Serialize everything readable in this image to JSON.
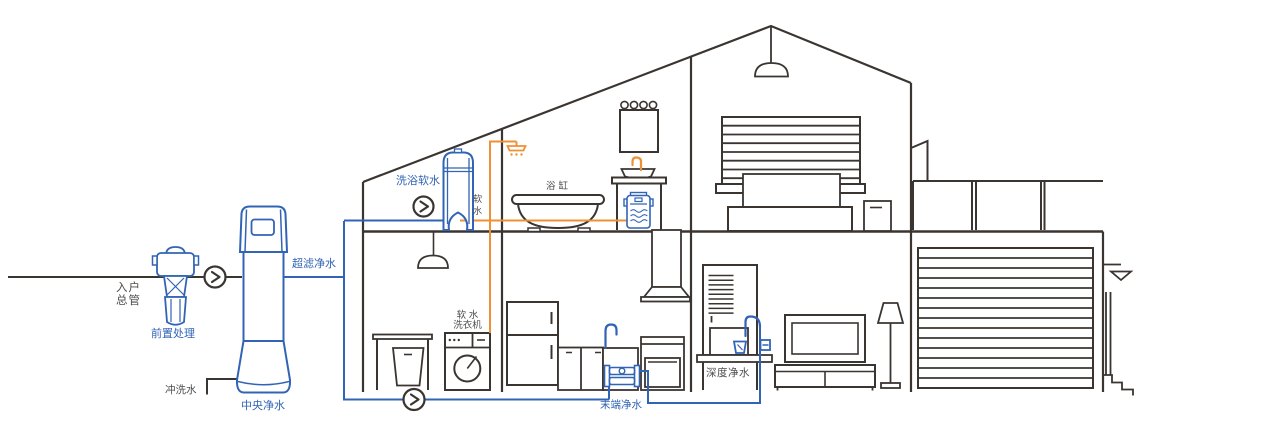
{
  "diagram": {
    "title": "house-water-purification-schematic",
    "background": "#ffffff",
    "colors": {
      "pipe_blue": "#3164b5",
      "pipe_orange": "#ee9036",
      "outline_dark": "#3b3531",
      "label_blue": "#3164b5",
      "label_gray": "#4c4c4c"
    },
    "labels": {
      "inlet_main": "入户\n总管",
      "pre_treatment": "前置处理",
      "ultrafiltration": "超滤净水",
      "flush_water": "冲洗水",
      "central_purifier": "中央净水",
      "bath_softener": "洗浴软水",
      "soft_water": "软水",
      "bathtub": "浴缸",
      "washer": "软 水\n洗衣机",
      "terminal_purifier": "末端净水",
      "deep_purifier": "深度净水"
    },
    "icons": {
      "flow_arrow": "chevron-right-icon"
    }
  }
}
